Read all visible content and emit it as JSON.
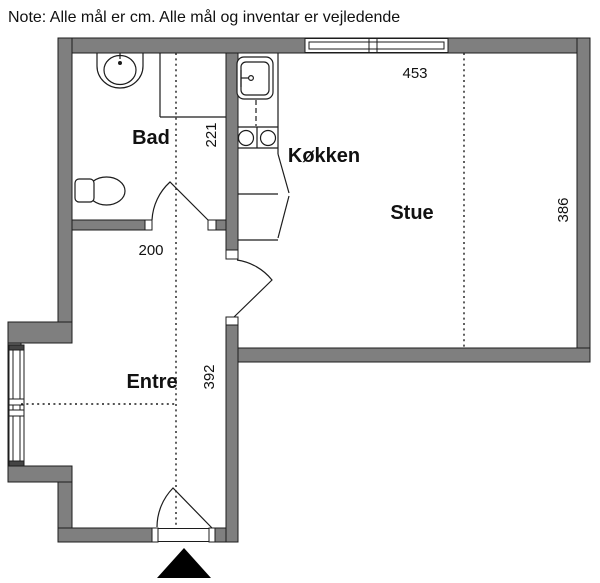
{
  "note": "Note: Alle mål er cm. Alle mål og inventar er vejledende",
  "rooms": {
    "bad": {
      "label": "Bad"
    },
    "kokken": {
      "label": "Køkken"
    },
    "stue": {
      "label": "Stue"
    },
    "entre": {
      "label": "Entre"
    }
  },
  "dimensions": {
    "stue_width": "453",
    "bad_depth": "221",
    "stue_depth": "386",
    "hall_width": "200",
    "hall_length": "392"
  },
  "colors": {
    "wall_fill": "#7f7f7f",
    "line": "#1c1c1c",
    "background": "#ffffff",
    "arrow": "#000000"
  },
  "fixtures": {
    "bathroom": [
      "washbasin",
      "toilet",
      "shower-corner",
      "bathroom-door"
    ],
    "kitchen": [
      "kitchen-sink",
      "dishwasher-dashed",
      "stove-two-burners",
      "base-cabinets"
    ],
    "openings": [
      "top-window",
      "entre-bay-window",
      "entrance-door",
      "stue-door"
    ],
    "marker": "entrance-direction-arrow"
  }
}
